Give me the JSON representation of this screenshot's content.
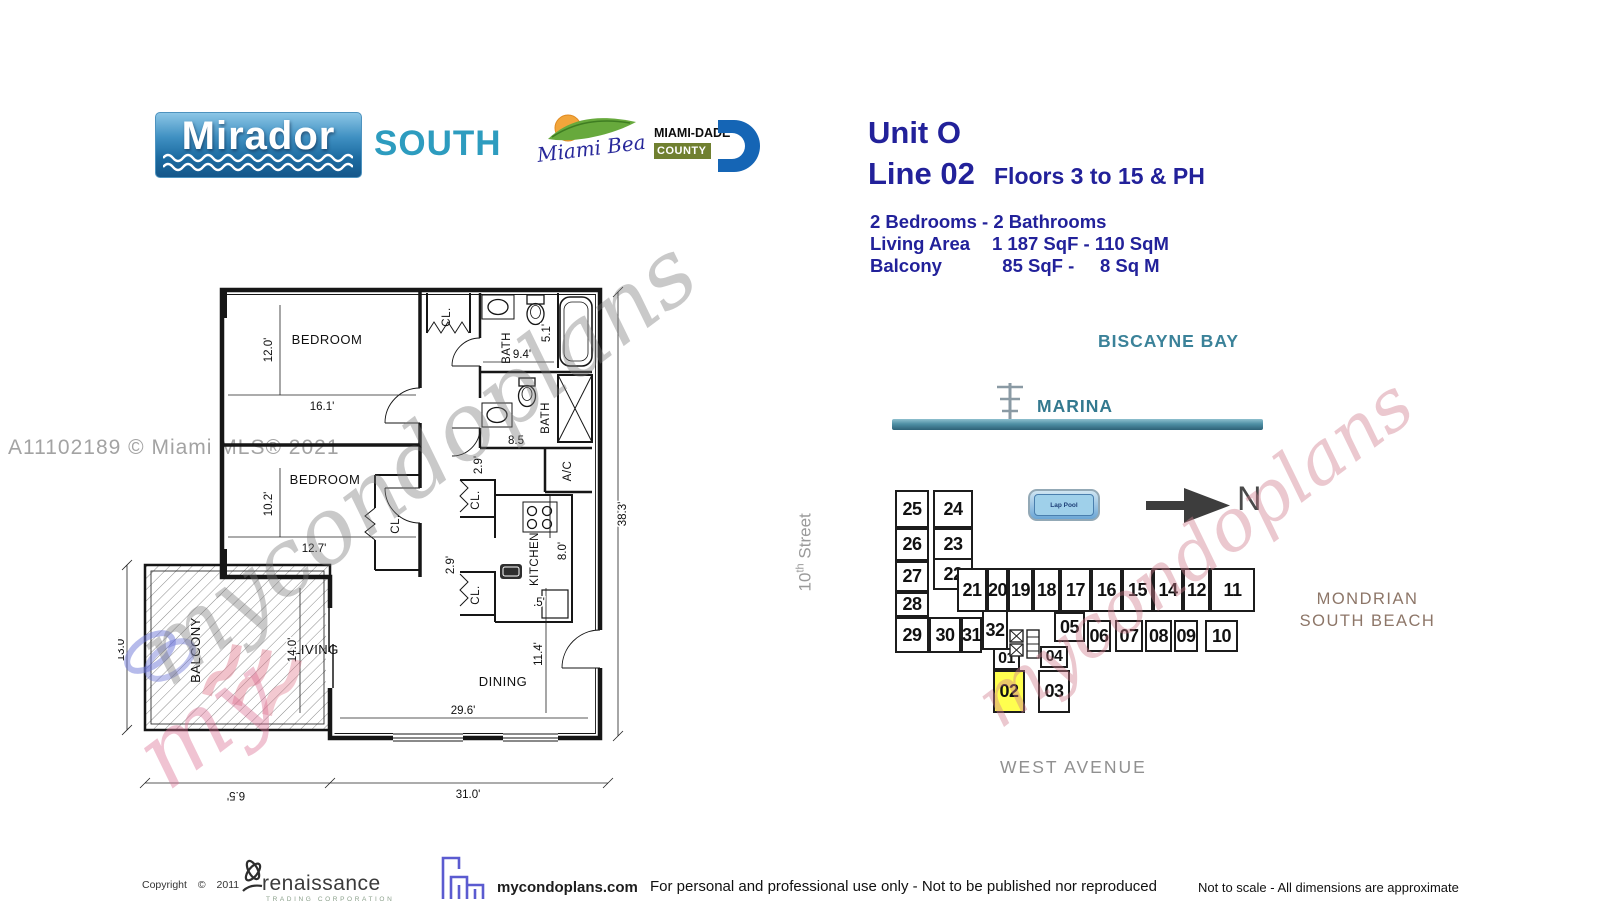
{
  "header": {
    "building_name": "Mirador",
    "building_suffix": "SOUTH",
    "miami_beach_logo": "Miami Beach",
    "county_line1": "MIAMI-DADE",
    "county_line2": "COUNTY"
  },
  "unit_info": {
    "unit": "Unit O",
    "line": "Line 02",
    "floors": "Floors 3 to 15 & PH",
    "bed_bath": "2 Bedrooms - 2 Bathrooms",
    "living_area_label": "Living Area",
    "living_area_value": "1 187 SqF - 110 SqM",
    "balcony_label": "Balcony",
    "balcony_value": "  85 SqF -     8 Sq M"
  },
  "mls_watermark": "A11102189 © Miami MLS® 2021",
  "watermarks": {
    "script_left": "mycondoplans",
    "script_my": "my",
    "script_right": "mycondoplans"
  },
  "floor_plan": {
    "rooms": {
      "bedroom1": "BEDROOM",
      "bedroom2": "BEDROOM",
      "bath1": "BATH",
      "bath2": "BATH",
      "ac": "A/C",
      "kitchen": "KITCHEN",
      "living": "LIVING",
      "dining": "DINING",
      "balcony": "BALCONY",
      "closet_top": "CL.",
      "closet_bedroom2": "CL.",
      "closet_hall1": "CL.",
      "closet_hall2": "CL."
    },
    "dims": {
      "bedroom1_h": "12.0'",
      "bedroom1_w": "16.1'",
      "bedroom2_h": "10.2'",
      "bedroom2_w": "12.7'",
      "balcony_h": "13.0'",
      "living_h": "14.0'",
      "dining_h": "11.4'",
      "living_w": "29.6'",
      "overall_w": "31.0'",
      "balcony_w": "6.5'",
      "overall_h": "38.3'",
      "bath1_w": "9.4'",
      "bath1_d": "5.1'",
      "bath2_w": "8.5",
      "hall1": "2.9'",
      "hall2": "2.9'",
      "kitchen_d": "8.0'",
      "kitchen_s": ".5'"
    }
  },
  "site_map": {
    "bay_label": "BISCAYNE BAY",
    "marina_label": "MARINA",
    "street_num": "10",
    "street_sup": "th",
    "street_word": " Street",
    "pool_label": "Lap Pool",
    "north_label": "N",
    "mondrian_line1": "MONDRIAN",
    "mondrian_line2": "SOUTH BEACH",
    "avenue_label": "WEST AVENUE",
    "highlighted_unit": "02",
    "units": {
      "u01": "01",
      "u02": "02",
      "u03": "03",
      "u04": "04",
      "u05": "05",
      "u06": "06",
      "u07": "07",
      "u08": "08",
      "u09": "09",
      "u10": "10",
      "u11": "11",
      "u12": "12",
      "u14": "14",
      "u15": "15",
      "u16": "16",
      "u17": "17",
      "u18": "18",
      "u19": "19",
      "u20": "20",
      "u21": "21",
      "u22": "22",
      "u23": "23",
      "u24": "24",
      "u25": "25",
      "u26": "26",
      "u27": "27",
      "u28": "28",
      "u29": "29",
      "u30": "30",
      "u31": "31",
      "u32": "32"
    }
  },
  "footer": {
    "copyright": "Copyright ©  2011",
    "renaissance": "renaissance",
    "renaissance_sub": "TRADING CORPORATION",
    "website": "mycondoplans.com",
    "disclaimer": "For personal and professional use only - Not to be published nor reproduced",
    "scale_note": "Not to scale - All dimensions are approximate"
  },
  "colors": {
    "navy": "#22219a",
    "teal": "#2d9cbf",
    "bay_teal": "#3b8299",
    "highlight_yellow": "#ffff4f",
    "mondrian_brown": "#8d7668",
    "pool_blue": "#9fd0ea"
  }
}
